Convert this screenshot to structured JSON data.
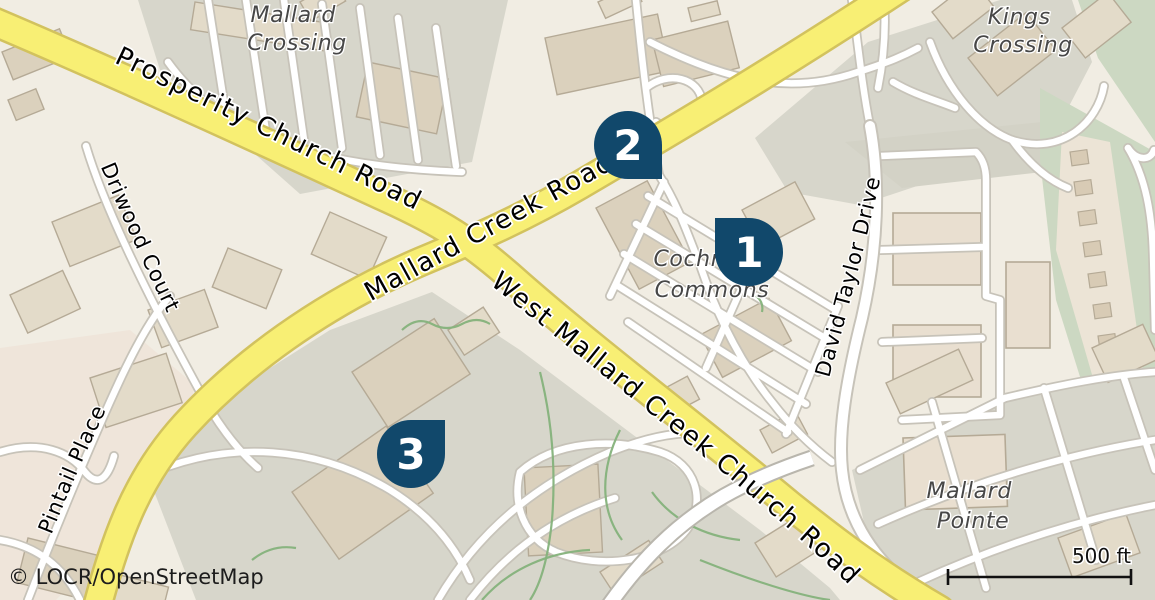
{
  "map": {
    "attribution": "© LOCR/OpenStreetMap",
    "scale_bar": {
      "label": "500 ft"
    },
    "markers": [
      {
        "number": "1"
      },
      {
        "number": "2"
      },
      {
        "number": "3"
      }
    ],
    "road_labels": {
      "prosperity": "Prosperity Church Road",
      "mallard_creek": "Mallard Creek Road",
      "west_mallard": "West Mallard Creek Church Road",
      "driwood": "Driwood Court",
      "pintail": "Pintail Place",
      "david_taylor": "David Taylor Drive"
    },
    "place_labels": {
      "mallard_crossing": {
        "line1": "Mallard",
        "line2": "Crossing"
      },
      "kings_crossing": {
        "line1": "Kings",
        "line2": "Crossing"
      },
      "cochran_commons": {
        "line1": "Cochran",
        "line2": "Commons"
      },
      "mallard_pointe": {
        "line1": "Mallard",
        "line2": "Pointe"
      }
    },
    "colors": {
      "marker": "#11486b",
      "road_primary": "#f8ef74",
      "road_primary_casing": "#d2c25e",
      "background": "#f1ede3",
      "parking_gray": "#d7d6cb",
      "green_area": "#ccd8c2",
      "building": "#e3dbc9",
      "building_stroke": "#b5aa96",
      "road_minor": "#ffffff",
      "road_minor_casing": "#c7c3b9",
      "hedge_green": "#85b27b",
      "place_label_text": "#474747",
      "road_label_text": "#000000"
    }
  }
}
